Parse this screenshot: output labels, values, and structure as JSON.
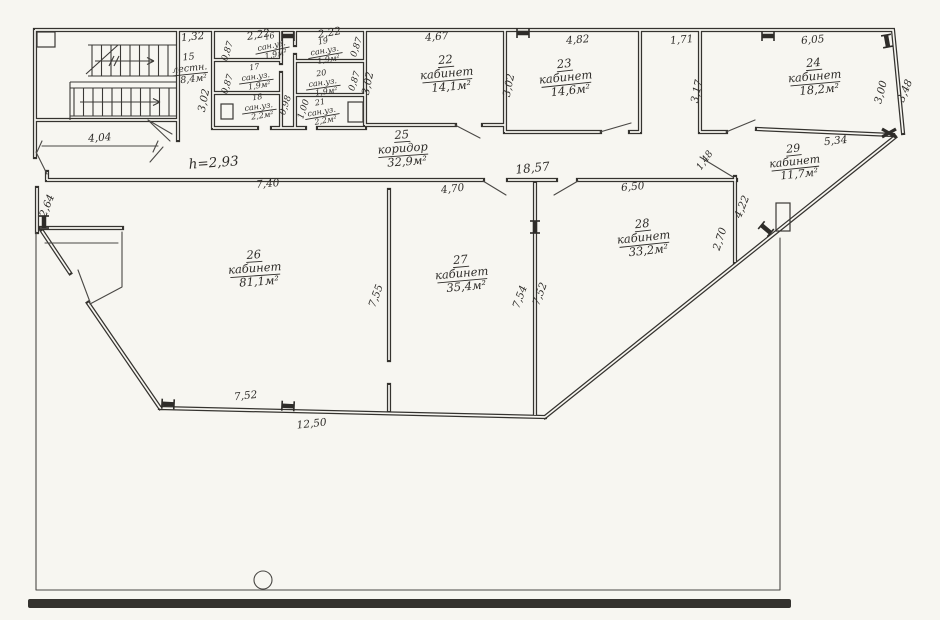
{
  "drawing": {
    "kind": "scanned hand-drawn floor plan",
    "ink_color": "#2e2c29",
    "paper_color": "#f7f6f1",
    "height_note": {
      "t": "h=2,93",
      "x": 214,
      "y": 167,
      "r": -4,
      "s": 13.5
    },
    "rooms": [
      {
        "number": "15",
        "name": "лестн.",
        "area": "8,4м²",
        "cx": 190,
        "cy": 71,
        "r": -6,
        "s": 9.5
      },
      {
        "number": "16",
        "name": "сан.уз.",
        "area": "1,9м²",
        "cx": 272,
        "cy": 48,
        "r": -12,
        "s": 8
      },
      {
        "number": "17",
        "name": "сан.уз.",
        "area": "1,9м²",
        "cx": 256,
        "cy": 79,
        "r": -8,
        "s": 8
      },
      {
        "number": "18",
        "name": "сан.уз.",
        "area": "2,2м²",
        "cx": 259,
        "cy": 109,
        "r": -8,
        "s": 8
      },
      {
        "number": "19",
        "name": "сан.уз.",
        "area": "1,9м²",
        "cx": 325,
        "cy": 53,
        "r": -10,
        "s": 8
      },
      {
        "number": "20",
        "name": "сан.уз.",
        "area": "1,9м²",
        "cx": 323,
        "cy": 85,
        "r": -8,
        "s": 8
      },
      {
        "number": "21",
        "name": "сан.уз.",
        "area": "2,2м²",
        "cx": 322,
        "cy": 114,
        "r": -10,
        "s": 8
      },
      {
        "number": "22",
        "name": "кабинет",
        "area": "14,1м²",
        "cx": 447,
        "cy": 77,
        "r": -5,
        "s": 11.5
      },
      {
        "number": "23",
        "name": "кабинет",
        "area": "14,6м²",
        "cx": 566,
        "cy": 81,
        "r": -6,
        "s": 11.5
      },
      {
        "number": "24",
        "name": "кабинет",
        "area": "18,2м²",
        "cx": 815,
        "cy": 80,
        "r": -5,
        "s": 11.5
      },
      {
        "number": "25",
        "name": "коридор",
        "area": "32,9м²",
        "cx": 403,
        "cy": 152,
        "r": -4,
        "s": 11.5
      },
      {
        "number": "26",
        "name": "кабинет",
        "area": "81,1м²",
        "cx": 255,
        "cy": 272,
        "r": -4,
        "s": 11.5
      },
      {
        "number": "27",
        "name": "кабинет",
        "area": "35,4м²",
        "cx": 462,
        "cy": 277,
        "r": -5,
        "s": 11.5
      },
      {
        "number": "28",
        "name": "кабинет",
        "area": "33,2м²",
        "cx": 644,
        "cy": 241,
        "r": -6,
        "s": 11.5
      },
      {
        "number": "29",
        "name": "кабинет",
        "area": "11,7м²",
        "cx": 795,
        "cy": 165,
        "r": -6,
        "s": 11
      }
    ],
    "dim_labels": [
      {
        "t": "1,32",
        "x": 193,
        "y": 40,
        "r": -6
      },
      {
        "t": "2,22",
        "x": 259,
        "y": 38,
        "r": -10
      },
      {
        "t": "2,22",
        "x": 330,
        "y": 36,
        "r": -10
      },
      {
        "t": "4,67",
        "x": 437,
        "y": 40,
        "r": -5
      },
      {
        "t": "4,82",
        "x": 578,
        "y": 43,
        "r": -5
      },
      {
        "t": "1,71",
        "x": 682,
        "y": 43,
        "r": -5
      },
      {
        "t": "6,05",
        "x": 813,
        "y": 43,
        "r": -5
      },
      {
        "t": "0,87",
        "x": 230,
        "y": 52,
        "r": -72,
        "s": 9
      },
      {
        "t": "0,87",
        "x": 230,
        "y": 85,
        "r": -72,
        "s": 9
      },
      {
        "t": "0,87",
        "x": 359,
        "y": 48,
        "r": -72,
        "s": 9
      },
      {
        "t": "0,87",
        "x": 357,
        "y": 82,
        "r": -72,
        "s": 9
      },
      {
        "t": "0,98",
        "x": 288,
        "y": 106,
        "r": -72,
        "s": 9
      },
      {
        "t": "1,00",
        "x": 306,
        "y": 110,
        "r": -72,
        "s": 9
      },
      {
        "t": "3,02",
        "x": 207,
        "y": 101,
        "r": -78
      },
      {
        "t": "3,02",
        "x": 371,
        "y": 84,
        "r": -78
      },
      {
        "t": "3,02",
        "x": 512,
        "y": 86,
        "r": -78
      },
      {
        "t": "3,17",
        "x": 700,
        "y": 92,
        "r": -78
      },
      {
        "t": "3,00",
        "x": 884,
        "y": 93,
        "r": -75
      },
      {
        "t": "3,48",
        "x": 908,
        "y": 92,
        "r": -68
      },
      {
        "t": "5,34",
        "x": 836,
        "y": 144,
        "r": -6
      },
      {
        "t": "4,04",
        "x": 100,
        "y": 141,
        "r": -4
      },
      {
        "t": "7,40",
        "x": 268,
        "y": 187,
        "r": -5
      },
      {
        "t": "4,70",
        "x": 453,
        "y": 192,
        "r": -7
      },
      {
        "t": "18,57",
        "x": 533,
        "y": 172,
        "r": -6,
        "s": 12
      },
      {
        "t": "6,50",
        "x": 633,
        "y": 190,
        "r": -5
      },
      {
        "t": "1,48",
        "x": 707,
        "y": 162,
        "r": -55,
        "s": 9.5
      },
      {
        "t": "4,22",
        "x": 745,
        "y": 208,
        "r": -68
      },
      {
        "t": "2,70",
        "x": 723,
        "y": 240,
        "r": -72
      },
      {
        "t": "2,64",
        "x": 50,
        "y": 207,
        "r": -68
      },
      {
        "t": "7,55",
        "x": 379,
        "y": 297,
        "r": -70
      },
      {
        "t": "7,54",
        "x": 523,
        "y": 298,
        "r": -70
      },
      {
        "t": "7,52",
        "x": 543,
        "y": 295,
        "r": -70
      },
      {
        "t": "7,52",
        "x": 246,
        "y": 399,
        "r": -6
      },
      {
        "t": "12,50",
        "x": 312,
        "y": 427,
        "r": -6
      }
    ],
    "window_marks": [
      {
        "x": 288,
        "y": 36,
        "r": 0
      },
      {
        "x": 523,
        "y": 33,
        "r": 0
      },
      {
        "x": 768,
        "y": 36,
        "r": 0
      },
      {
        "x": 887,
        "y": 41,
        "r": 80
      },
      {
        "x": 44,
        "y": 222,
        "r": 90
      },
      {
        "x": 168,
        "y": 404,
        "r": 3
      },
      {
        "x": 288,
        "y": 406,
        "r": 3
      },
      {
        "x": 535,
        "y": 227,
        "r": 90
      },
      {
        "x": 766,
        "y": 229,
        "r": 40
      }
    ],
    "corner_marks": [
      {
        "x": 889,
        "y": 133
      }
    ]
  }
}
